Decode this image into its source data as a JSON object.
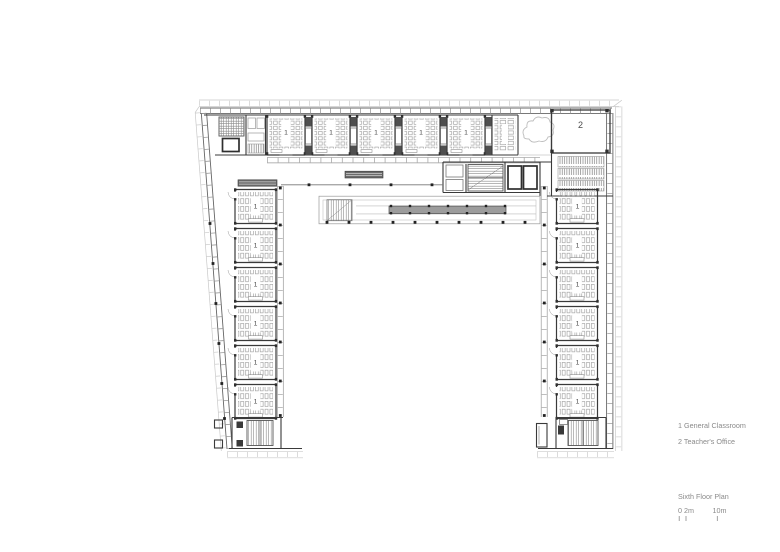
{
  "page": {
    "background": "#ffffff"
  },
  "plan": {
    "classroom_label": "1",
    "teachers_office_label": "2",
    "colors": {
      "wall": "#3a3a3a",
      "light_grid": "#c9c9c9",
      "desk_outline": "#8f8f8f",
      "skylight_fill": "#9c9c9c",
      "annotation_text": "#8a8a8a"
    }
  },
  "legend": {
    "items": [
      {
        "text": "1 General Classroom"
      },
      {
        "text": "2 Teacher's Office"
      }
    ]
  },
  "title_block": {
    "title": "Sixth Floor Plan",
    "scale_labels": [
      "0 2m",
      "10m"
    ]
  }
}
